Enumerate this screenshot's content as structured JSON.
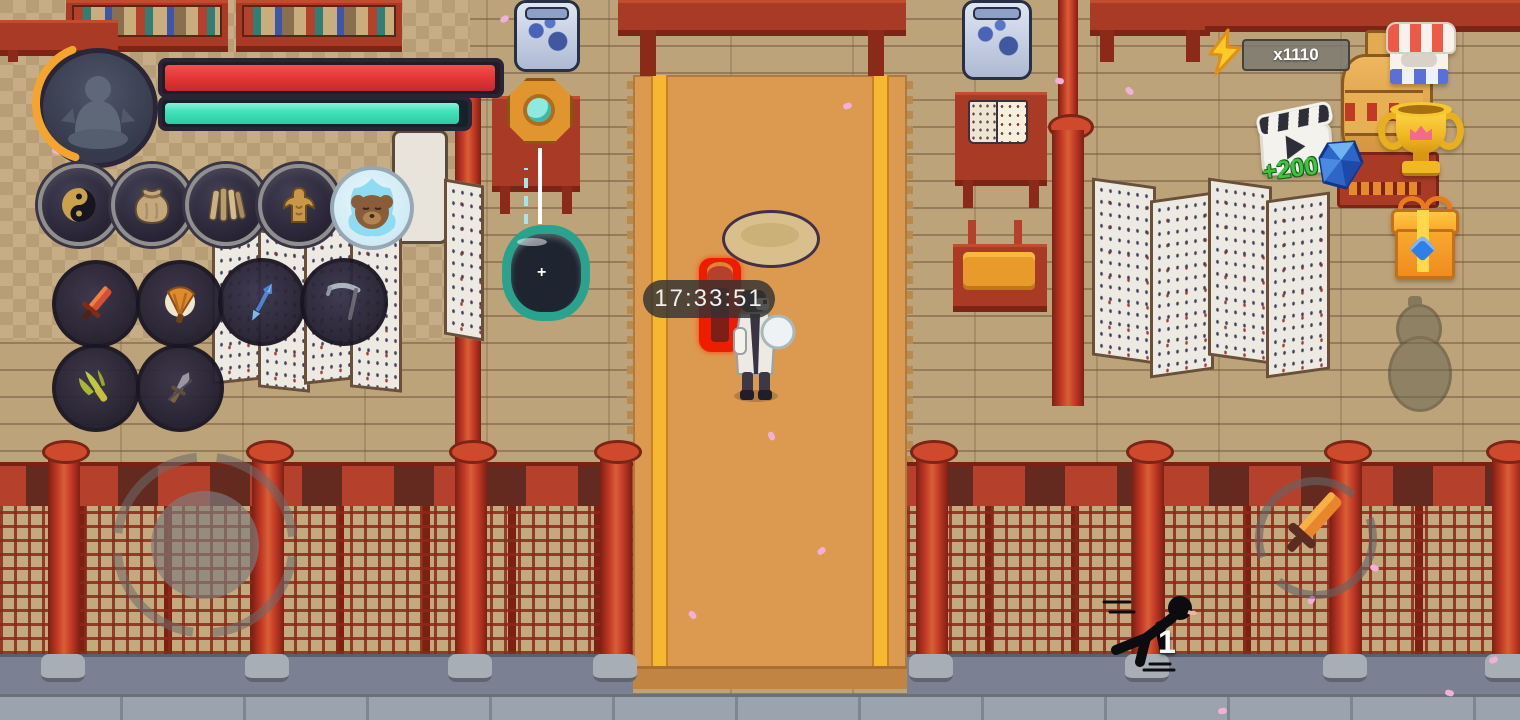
{
  "hud": {
    "timer_text": "17:33:51",
    "energy_count": "x1110",
    "ad_bonus_text": "+200",
    "sprint_count": "1"
  },
  "player": {
    "avatar_icon": "meditating-figure-icon",
    "hp_color": "#e6383a",
    "hp_percent": 100,
    "mp_color": "#41e3bb",
    "mp_percent": 97,
    "xp_arc_color": "#f5a52d"
  },
  "quick_slots": [
    {
      "icon": "yin-yang-icon"
    },
    {
      "icon": "pouch-icon"
    },
    {
      "icon": "bamboo-scroll-icon"
    },
    {
      "icon": "bronze-body-icon"
    },
    {
      "icon": "pet-bear-icon"
    }
  ],
  "weapon_slots": [
    {
      "icon": "red-sword-icon"
    },
    {
      "icon": "fire-fan-icon"
    },
    {
      "icon": "blue-spear-icon"
    },
    {
      "icon": "scythe-icon"
    },
    {
      "icon": "green-claw-icon"
    },
    {
      "icon": "dagger-icon"
    }
  ],
  "top_right": {
    "energy_icon": "lightning-icon",
    "shop_icon": "shop-icon",
    "trophy_icon": "trophy-icon",
    "video_ad_icon": "video-ad-icon",
    "gem_icon": "gem-icon",
    "gift_icon": "gift-icon",
    "gourd_icon": "gourd-icon"
  },
  "controls": {
    "joystick": "virtual-joystick",
    "attack_icon": "sword-icon",
    "sprint_icon": "running-figure-icon"
  },
  "scene": {
    "objects": [
      "bookshelf",
      "altar-table",
      "porcelain-jar",
      "bagua-mirror",
      "water-cauldron",
      "open-book-table",
      "bench",
      "folding-screen",
      "golden-vase",
      "meditation-cushion",
      "red-pillar",
      "lattice-fence",
      "hero-character",
      "glowing-sword-drop",
      "flower-petals"
    ]
  }
}
